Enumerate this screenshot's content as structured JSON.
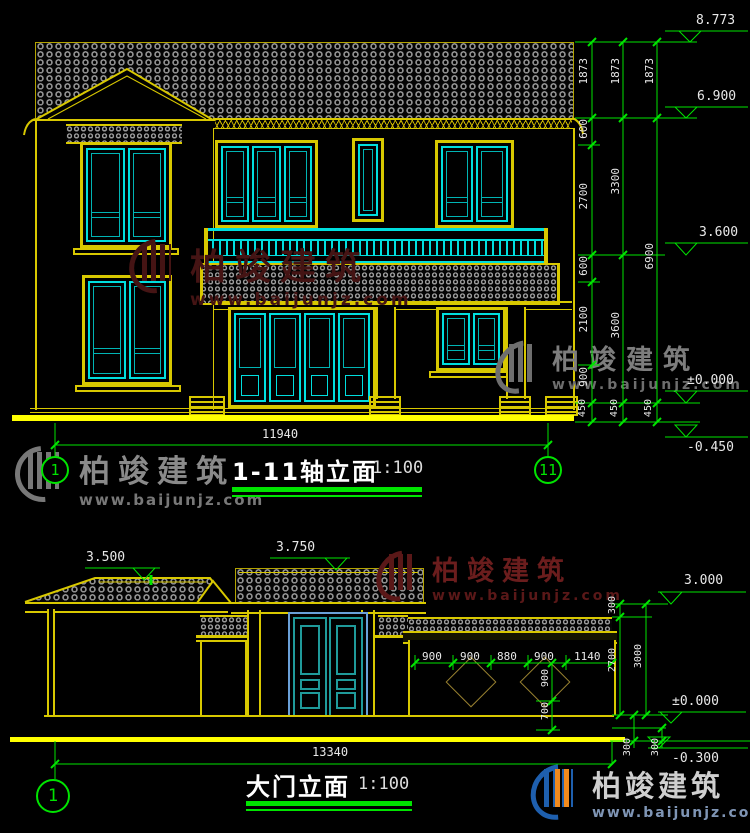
{
  "watermark": {
    "brand": "柏竣建筑",
    "url": "www.baijunjz.com"
  },
  "top_drawing": {
    "title": "1-11轴立面",
    "scale": "1:100",
    "axis_left": "1",
    "axis_right": "11",
    "overall_width": "11940",
    "levels": {
      "ridge": "8.773",
      "eave": "6.900",
      "balcony": "3.600",
      "floor": "±0.000",
      "ground": "-0.450"
    },
    "dim_chain_inner": [
      "1873",
      "600",
      "2700",
      "600",
      "2100",
      "900",
      "450"
    ],
    "dim_chain_mid": [
      "1873",
      "3300",
      "3600",
      "450"
    ],
    "dim_chain_outer": [
      "1873",
      "6900",
      "450"
    ]
  },
  "bottom_drawing": {
    "title": "大门立面",
    "scale": "1:100",
    "axis_left": "1",
    "overall_width": "13340",
    "levels": {
      "pavilion": "3.500",
      "gate": "3.750",
      "wall": "3.000",
      "floor": "±0.000",
      "ground": "-0.300"
    },
    "wall_dims": [
      "900",
      "900",
      "880",
      "900",
      "1140"
    ],
    "wall_vert_dims": [
      "900",
      "700"
    ],
    "right_chain": [
      "300",
      "2700",
      "3000"
    ],
    "base_dims": [
      "300",
      "300"
    ]
  }
}
